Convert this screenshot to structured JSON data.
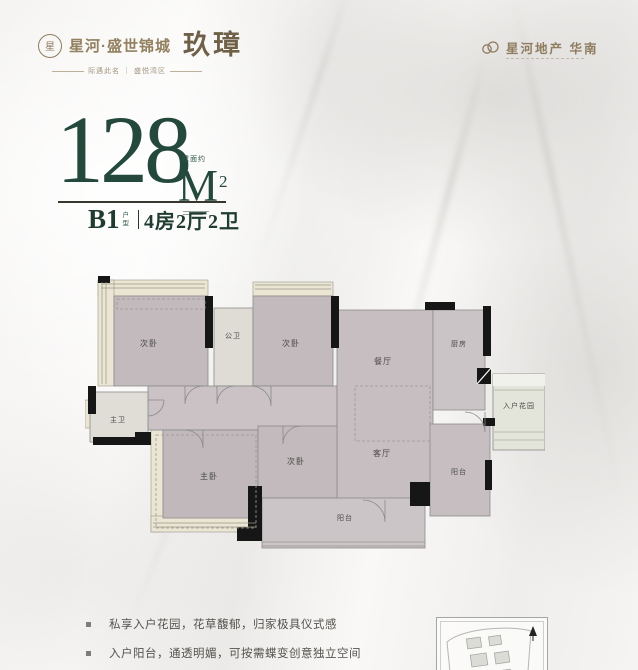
{
  "brand": {
    "name": "星河·盛世锦城",
    "product": "玖璋",
    "tagline": "际遇此名 ｜ 盛悦湾区",
    "badge_glyph": "星",
    "developer": "星河地产  华南"
  },
  "unit": {
    "area_prefix": "建面约",
    "area_value": "128",
    "area_unit": "M",
    "area_sup": "2",
    "type_code": "B1",
    "type_label_top": "户",
    "type_label_bottom": "型",
    "layout": "4房2厅2卫"
  },
  "plan": {
    "rooms": [
      {
        "id": "bedroom-2-a",
        "label": "次卧"
      },
      {
        "id": "public-bath",
        "label": "公卫"
      },
      {
        "id": "bedroom-2-b",
        "label": "次卧"
      },
      {
        "id": "dining-room",
        "label": "餐厅"
      },
      {
        "id": "kitchen",
        "label": "厨房"
      },
      {
        "id": "entry-garden",
        "label": "入户花园"
      },
      {
        "id": "master-bath",
        "label": "主卫"
      },
      {
        "id": "master-bedroom",
        "label": "主卧"
      },
      {
        "id": "bedroom-2-c",
        "label": "次卧"
      },
      {
        "id": "living-room",
        "label": "客厅"
      },
      {
        "id": "balcony",
        "label": "阳台"
      },
      {
        "id": "service-balcony",
        "label": "阳台"
      }
    ]
  },
  "features": [
    {
      "text": "私享入户花园，花草馥郁，归家极具仪式感"
    },
    {
      "text": "入户阳台，通透明媚，可按需蝶变创意独立空间"
    }
  ],
  "colors": {
    "accent_green": "#24493c",
    "brand_taupe": "#8f7c5f",
    "room_gray": "#c2babc",
    "bath_gray": "#dfdbd5",
    "bay_cream": "#ebe6d4",
    "wall_black": "#161616",
    "text_gray": "#55534f"
  }
}
